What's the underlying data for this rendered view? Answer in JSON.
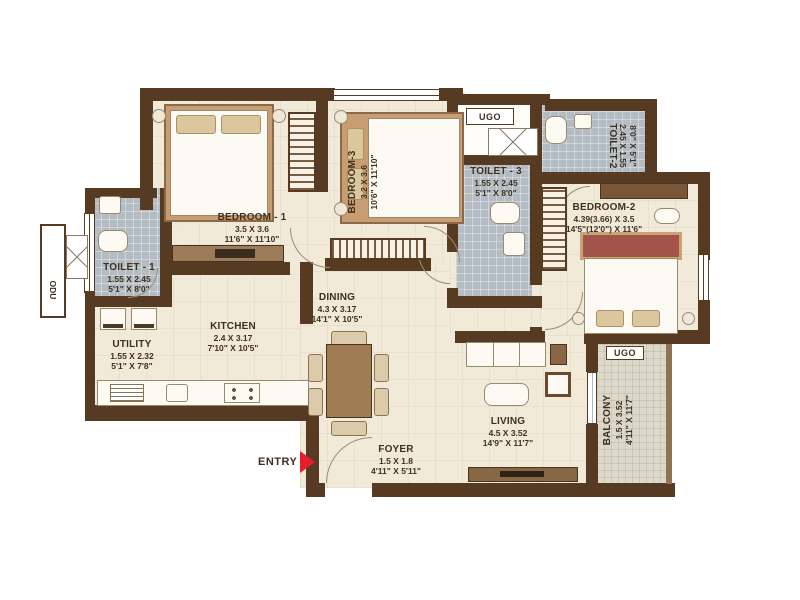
{
  "plan": {
    "entry_label": "ENTRY",
    "rooms": {
      "bedroom1": {
        "name": "BEDROOM - 1",
        "dim_m": "3.5 X 3.6",
        "dim_ft": "11'6\" X 11'10\""
      },
      "bedroom2": {
        "name": "BEDROOM-2",
        "dim_m": "4.39(3.66) X 3.5",
        "dim_ft": "14'5\"(12'0\") X 11'6\""
      },
      "bedroom3": {
        "name": "BEDROOM-3",
        "dim_m": "3.2 X 3.6",
        "dim_ft": "10'6\" X 11'10\""
      },
      "toilet1": {
        "name": "TOILET - 1",
        "dim_m": "1.55 X 2.45",
        "dim_ft": "5'1\" X 8'0\""
      },
      "toilet2": {
        "name": "TOILET-2",
        "dim_m": "2.45 X 1.55",
        "dim_ft": "8'0\" X 5'1\""
      },
      "toilet3": {
        "name": "TOILET - 3",
        "dim_m": "1.55 X 2.45",
        "dim_ft": "5'1\" X 8'0\""
      },
      "kitchen": {
        "name": "KITCHEN",
        "dim_m": "2.4 X 3.17",
        "dim_ft": "7'10\" X 10'5\""
      },
      "utility": {
        "name": "UTILITY",
        "dim_m": "1.55 X 2.32",
        "dim_ft": "5'1\" X 7'8\""
      },
      "dining": {
        "name": "DINING",
        "dim_m": "4.3 X 3.17",
        "dim_ft": "14'1\" X 10'5\""
      },
      "living": {
        "name": "LIVING",
        "dim_m": "4.5 X 3.52",
        "dim_ft": "14'9\" X 11'7\""
      },
      "foyer": {
        "name": "FOYER",
        "dim_m": "1.5 X 1.8",
        "dim_ft": "4'11\" X 5'11\""
      },
      "balcony": {
        "name": "BALCONY",
        "dim_m": "1.5 X 3.52",
        "dim_ft": "4'11\" X 11'7\""
      }
    },
    "annotations": {
      "ugo_top": "UGO",
      "ugo_balcony": "UGO",
      "odu": "ODU"
    },
    "colors": {
      "wall": "#573a22",
      "floor": "#f1ead9",
      "toilet_tile": "#b4bcc3",
      "balcony_tile": "#dcd8ca",
      "entry_arrow": "#e41e2b",
      "label_text": "#40301f"
    }
  }
}
